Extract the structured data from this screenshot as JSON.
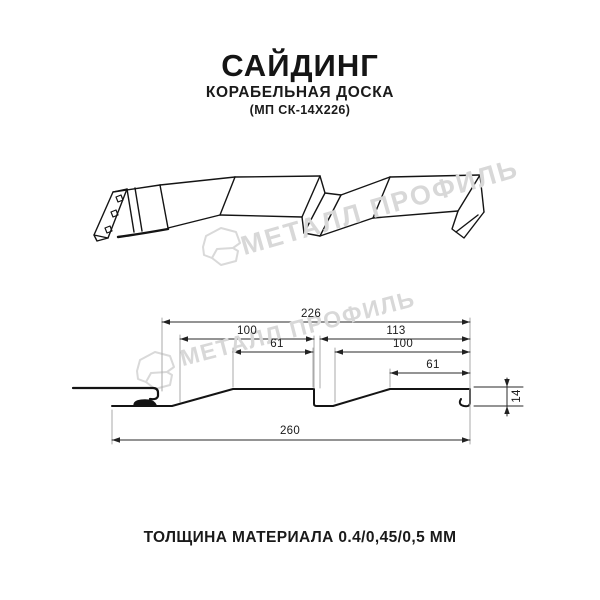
{
  "header": {
    "title": "САЙДИНГ",
    "subtitle": "КОРАБЕЛЬНАЯ ДОСКА",
    "product_code": "(МП СК-14Х226)"
  },
  "watermark": {
    "brand": "МЕТАЛЛ ПРОФИЛЬ",
    "logo_icon": "metal-profil-logo",
    "color": "#d8d8d8"
  },
  "section": {
    "dimensions": {
      "overall_width": "226",
      "left_span": "100",
      "right_span": "113",
      "left_flat": "61",
      "right_inner_span": "100",
      "right_flat": "61",
      "total_width": "260",
      "profile_height": "14"
    }
  },
  "footer": {
    "material_thickness": "ТОЛЩИНА МАТЕРИАЛА 0.4/0,45/0,5 ММ"
  },
  "colors": {
    "background": "#ffffff",
    "drawing_line": "#141414",
    "dimension_line": "#2a2a2a",
    "extension_line": "#aaaaaa",
    "watermark": "#d8d8d8",
    "text": "#1a1a1a"
  }
}
